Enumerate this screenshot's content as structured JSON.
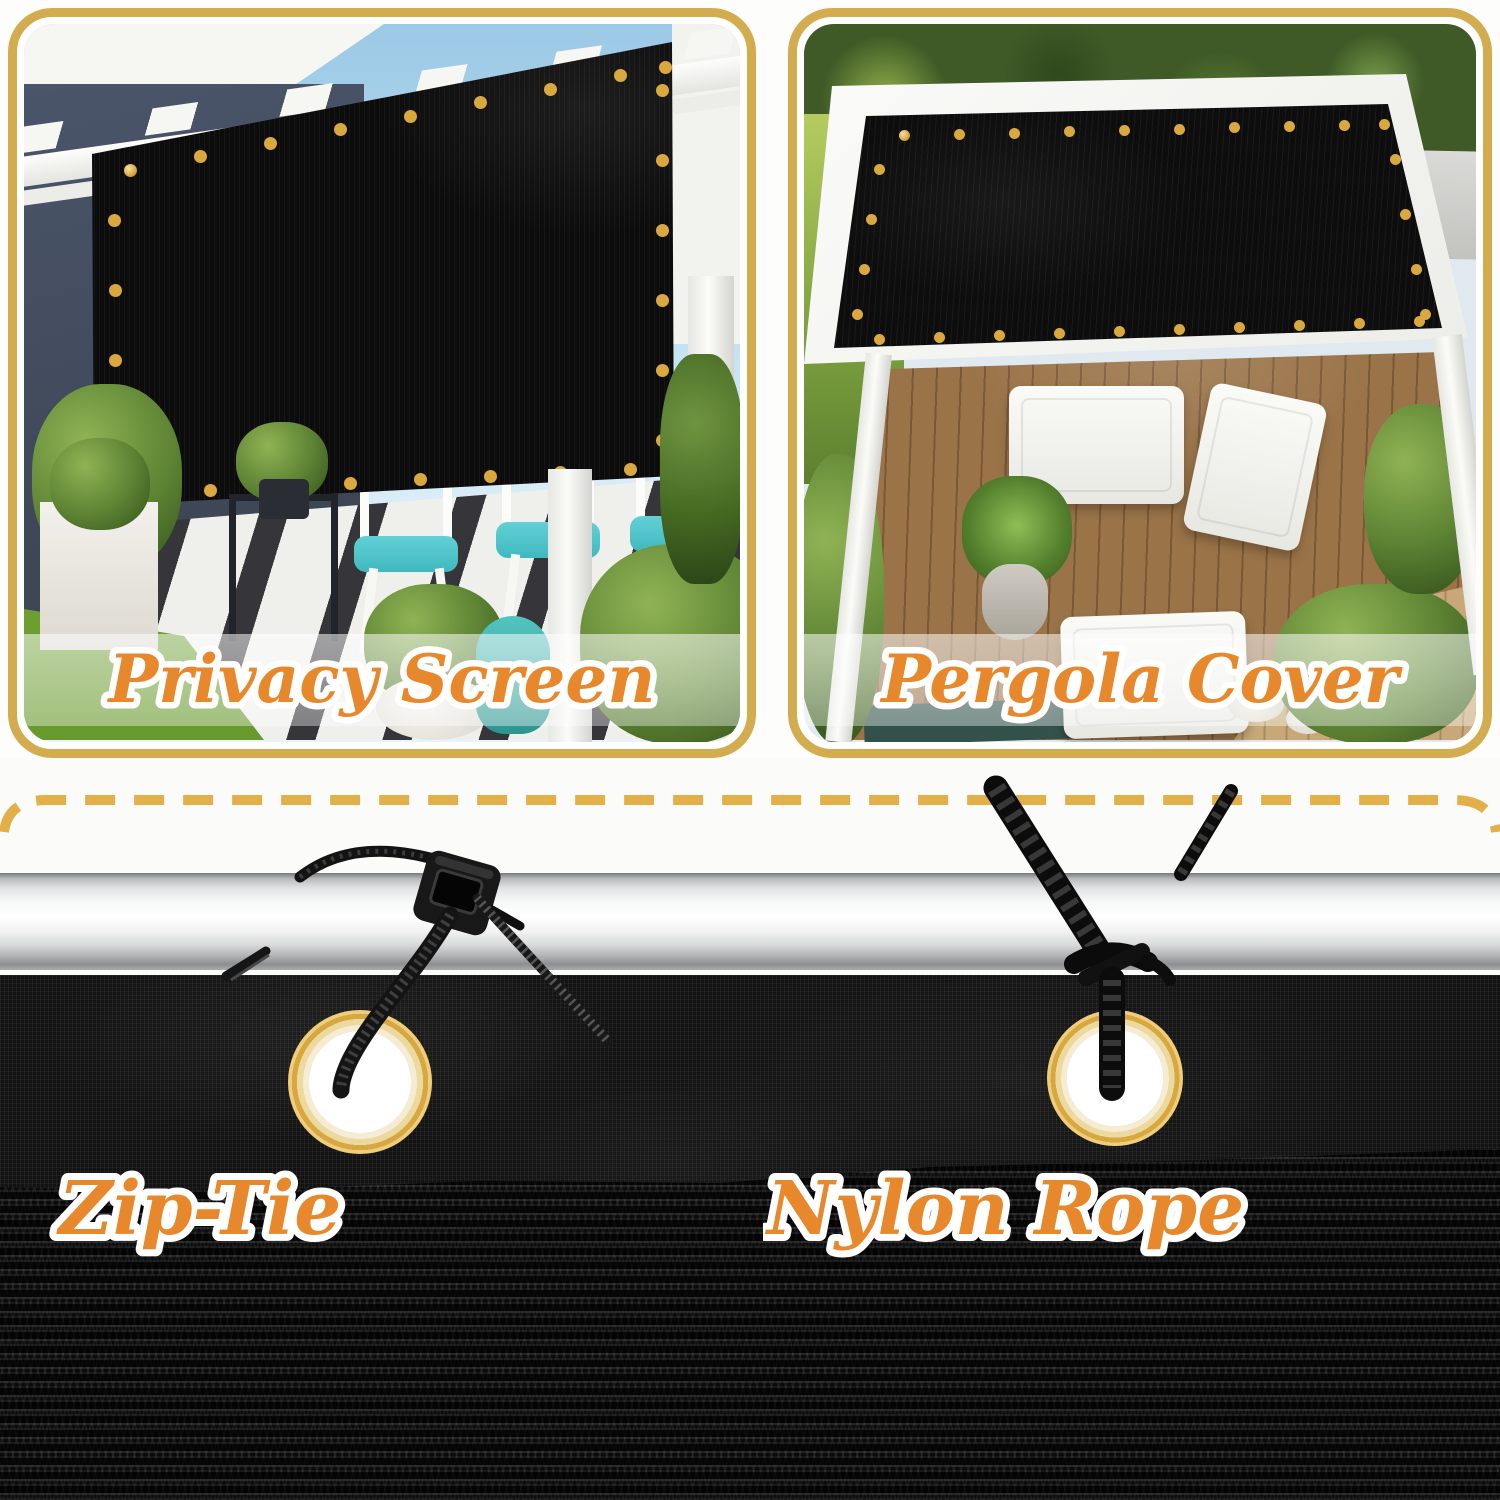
{
  "panels": [
    {
      "label": "Privacy Screen"
    },
    {
      "label": "Pergola Cover"
    }
  ],
  "attachments": [
    {
      "label": "Zip-Tie"
    },
    {
      "label": "Nylon Rope"
    }
  ],
  "colors": {
    "label_orange": "#E7882C",
    "label_outline": "#FFFFFF",
    "panel_border_gold": "#D3AC4F",
    "dash_gold": "#E2AF49",
    "grommet_gold": "#D79C35",
    "fabric_black": "#131313",
    "sky_blue": "#A9D0E8",
    "grass_green": "#84B13E",
    "deck_brown": "#9A7348",
    "cushion_teal": "#3FB9BE"
  }
}
